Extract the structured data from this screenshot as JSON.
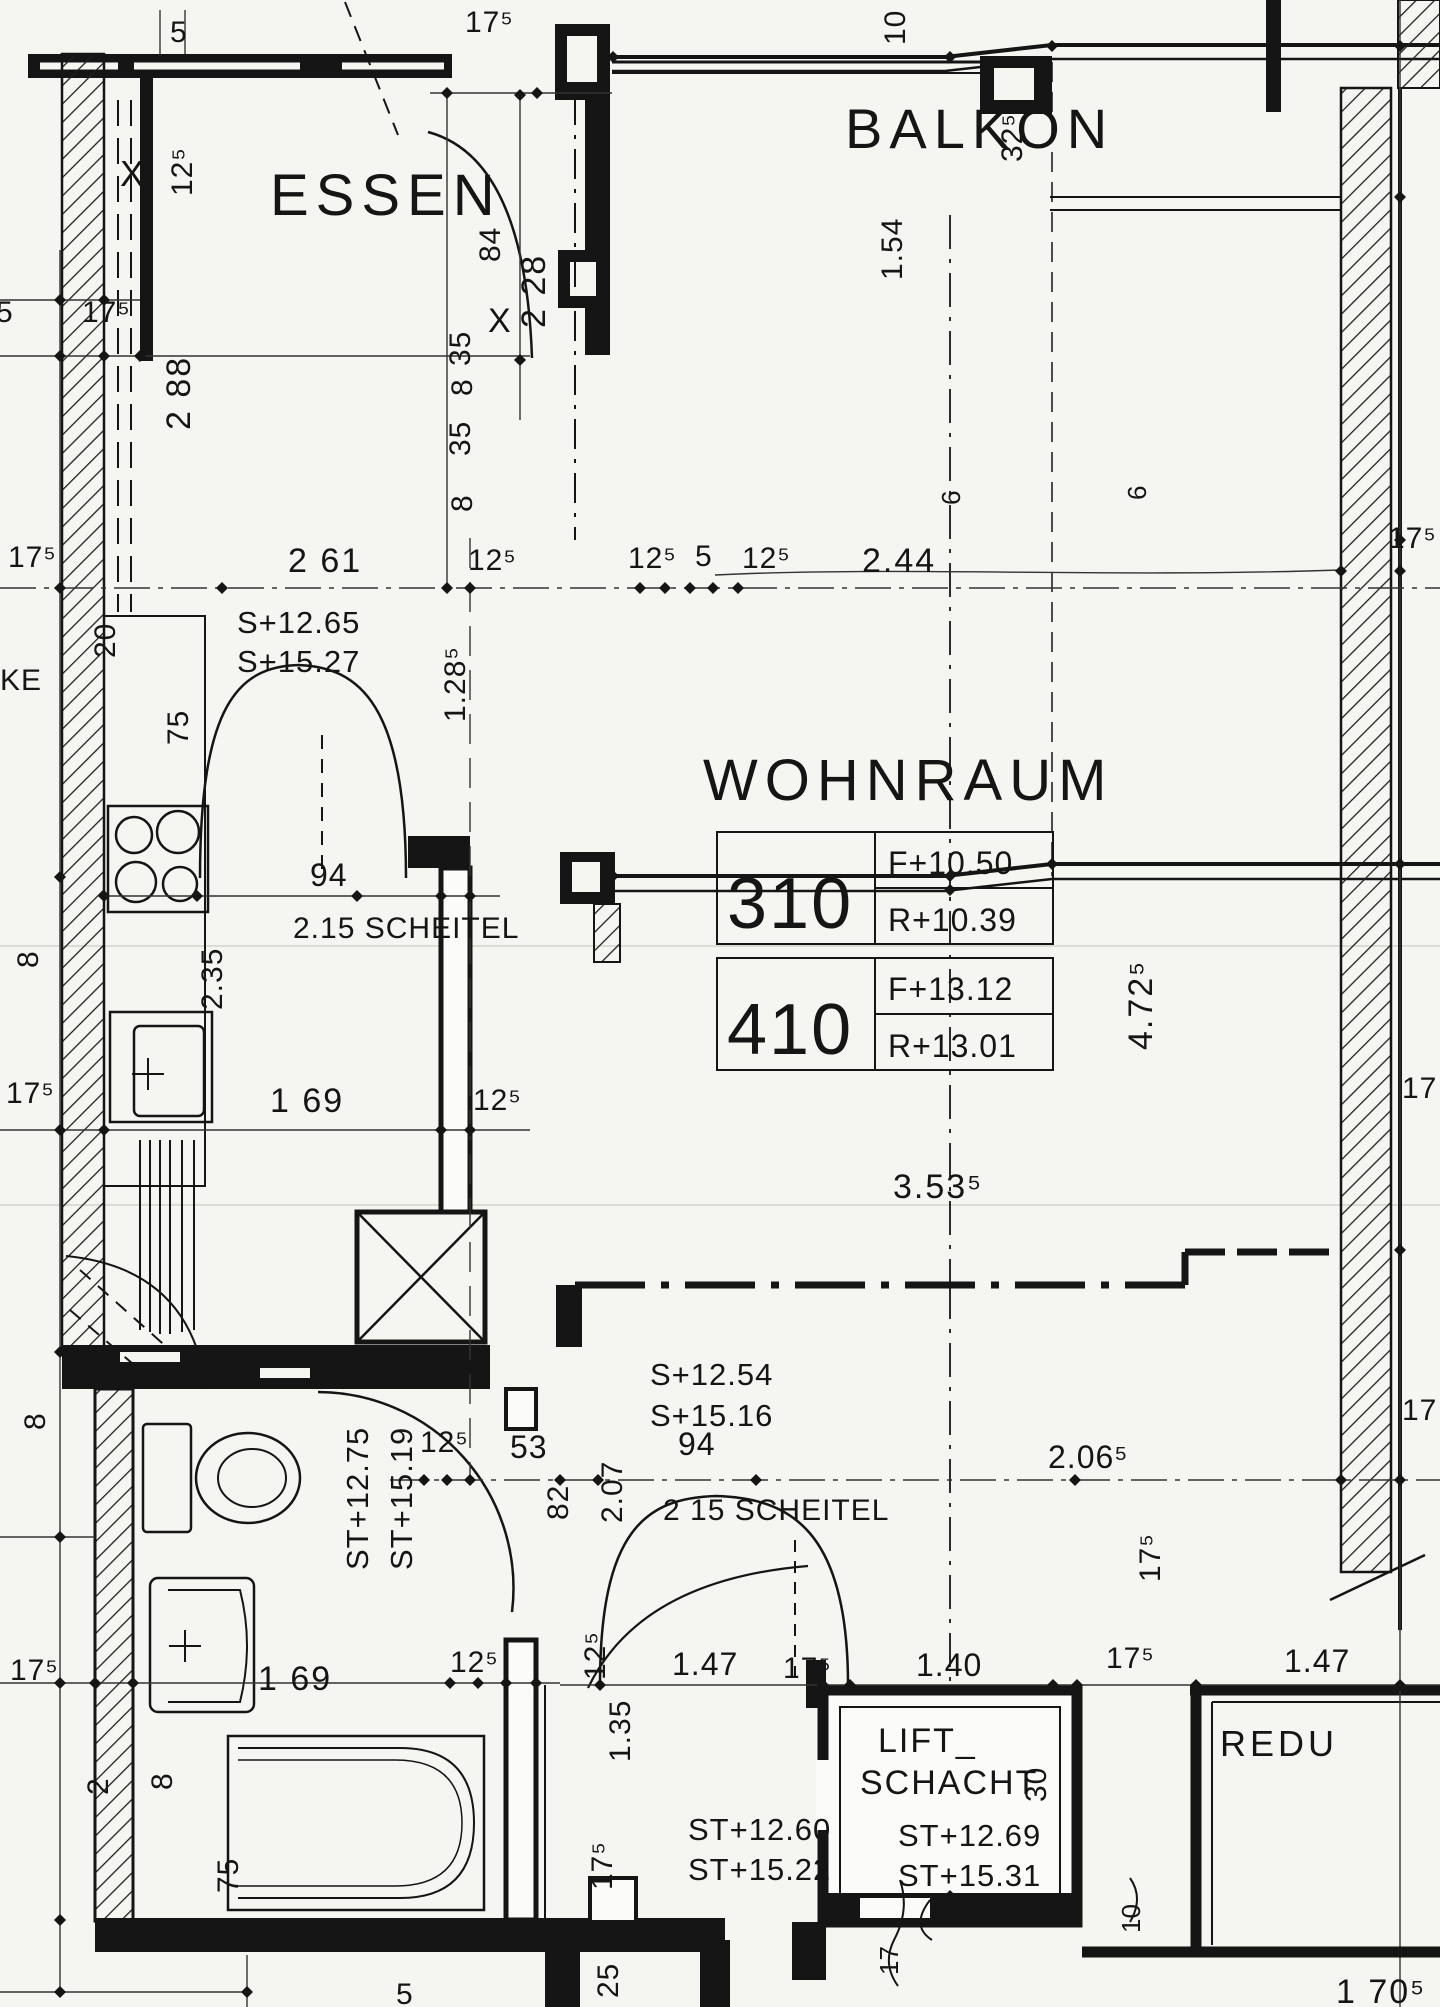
{
  "document": {
    "kind": "scanned architectural floor plan",
    "language": "de",
    "ink_color": "#151515",
    "paper_color": "#f5f5f2"
  },
  "labels": {
    "room_essen": "ESSEN",
    "room_balkon": "BALKON",
    "room_wohnraum": "WOHNRAUM",
    "room_lift_1": "LIFT_",
    "room_lift_2": "SCHACHT",
    "room_redu": "REDU",
    "frag_ke": "KE",
    "tbl_310_no": "310",
    "tbl_310_f": "F+10.50",
    "tbl_310_r": "R+10.39",
    "tbl_410_no": "410",
    "tbl_410_f": "F+13.12",
    "tbl_410_r": "R+13.01",
    "lvl_essen_1": "S+12.65",
    "lvl_essen_2": "S+15.27",
    "lvl_wohn_1": "S+12.54",
    "lvl_wohn_2": "S+15.16",
    "lvl_wc_1": "ST+12.75",
    "lvl_wc_2": "ST+15.19",
    "lvl_bad_1": "ST+12.60",
    "lvl_bad_2": "ST+15.22",
    "lvl_lift_1": "ST+12.69",
    "lvl_lift_2": "ST+15.31",
    "note_scheitel_1": "2.15 SCHEITEL",
    "note_scheitel_2": "2 15 SCHEITEL",
    "d_top5": "5",
    "d_top175": "17⁵",
    "d_top10": "10",
    "d_top325": "32⁵",
    "d_125v": "12⁵",
    "d_x1": "X",
    "d_175l1": "17⁵",
    "d_5l": "5",
    "d_288": "2 88",
    "d_84": "84",
    "d_228": "2 28",
    "d_35a": "35",
    "d_x2": "X",
    "d_8a": "8",
    "d_35b": "35",
    "d_8b": "8",
    "d_154": "1.54",
    "d_261": "2 61",
    "d_125a": "12⁵",
    "d_125b": "12⁵",
    "d_5m": "5",
    "d_125c": "12⁵",
    "d_244": "2.44",
    "d_175r1": "17⁵",
    "d_175l2": "17⁵",
    "d_6a": "6",
    "d_6b": "6",
    "d_20": "20",
    "d_1285": "1.28⁵",
    "d_75a": "75",
    "d_94a": "94",
    "d_235": "2.35",
    "d_175l3": "17⁵",
    "d_169": "1 69",
    "d_125d": "12⁵",
    "d_8c": "8",
    "d_4725": "4.72⁵",
    "d_17r1": "17",
    "d_3535": "3.53⁵",
    "d_125e": "12⁵",
    "d_53": "53",
    "d_82": "82",
    "d_207": "2.07",
    "d_94b": "94",
    "d_2065": "2.06⁵",
    "d_17r2": "17",
    "d_8d": "8",
    "d_175l4": "17⁵",
    "d_125f": "12⁵",
    "d_125g": "12⁵",
    "d_135": "1.35",
    "d_175v1": "17⁵",
    "d_2bl": "2",
    "d_8bl": "8",
    "d_75b": "75",
    "d_147a": "1.47",
    "d_175m1": "17⁵",
    "d_140": "1.40",
    "d_175m2": "17⁵",
    "d_147b": "1.47",
    "d_175v2": "17⁵",
    "d_30": "30",
    "d_25": "25",
    "d_5b": "5",
    "d_17s": "17",
    "d_10s": "10",
    "d_1705": "1 70⁵"
  }
}
